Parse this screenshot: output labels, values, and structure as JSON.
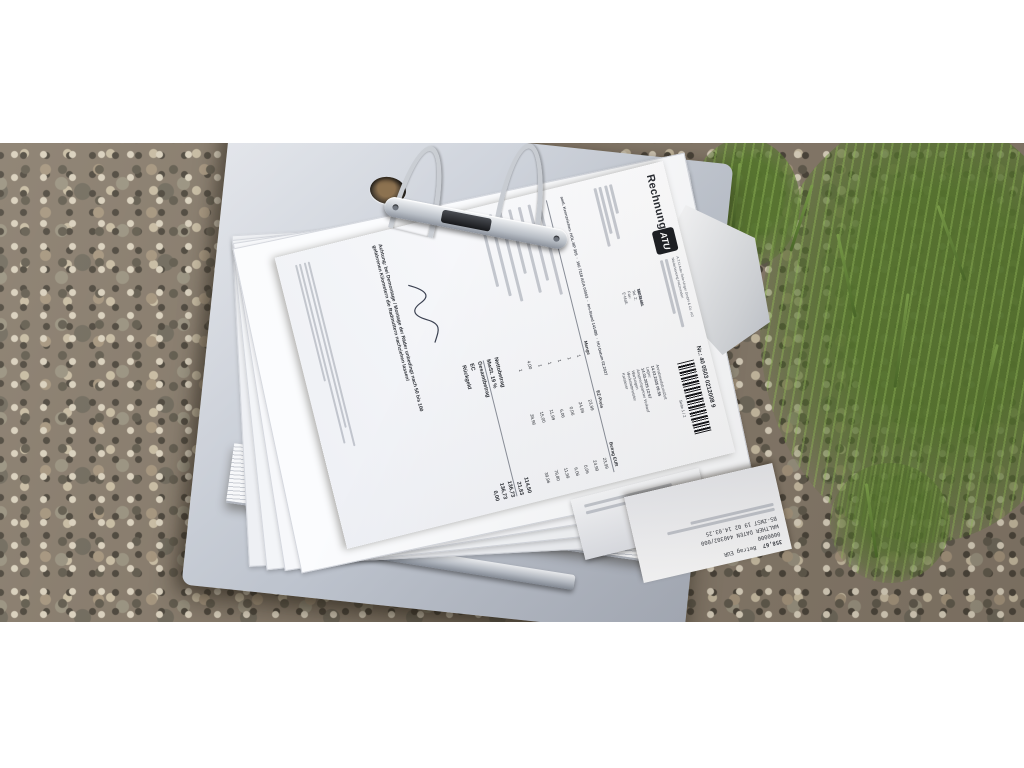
{
  "colors": {
    "gravel_base": "#85796a",
    "stone_light": "#d8cfbc",
    "stone_dark": "#4a443a",
    "grass_green": "#587830",
    "binder_gray": "#c3c8d2",
    "paper_white": "#fafbfd",
    "ink": "#2a2d33"
  },
  "invoice": {
    "title": "Rechnung",
    "brand": "ATU",
    "sender_line1": "A.T.U Auto-Teile-Unger GmbH & Co. KG",
    "sender_line2": "Niederlassung Holzminden",
    "doc_no": "Nr.: 40 0503 0212008 9",
    "page_label": "Seite 1 / 2",
    "customer_no_label": "Kundennr.",
    "customer_no": "10771481",
    "contact_labels": {
      "tel1": "Tel. 1:",
      "tel2": "Tel. 2:",
      "fax": "Fax:",
      "email": "E-Mail:"
    },
    "meta": {
      "l1": "Annahmedatum/Zeit",
      "v1": "14.03.2025 09:55",
      "l2": "Lager:",
      "v2": "14.03.2025 12:57",
      "l3": "Ansprechpartner Verkauf",
      "l4": "Wartungen",
      "l5": "Werkstattmeister",
      "l6": "Kassierer"
    },
    "vehicle": {
      "plate_label": "amtl. Kennzeichen:",
      "plate": "HOL-NP 305",
      "part_no": "160 7118 AGA 00003",
      "km_label": "km-Stand",
      "km": "141489",
      "hu_label": "HU-Datum",
      "hu": "02.2027"
    },
    "table": {
      "headers": {
        "qty": "Menge",
        "unit": "EZ-Preis",
        "amount": "Betrag EUR"
      },
      "rows": [
        {
          "qty": "1",
          "unit": "23,99",
          "amount": "23,99"
        },
        {
          "qty": "1",
          "unit": "24,99",
          "amount": "24,99"
        },
        {
          "qty": "1",
          "unit": "0,06",
          "amount": "0,06"
        },
        {
          "qty": "1",
          "unit": "6,06",
          "amount": "6,06"
        },
        {
          "qty": "1",
          "unit": "11,99",
          "amount": "11,99"
        },
        {
          "qty": "4,00",
          "unit": "15,00",
          "amount": "79,80"
        },
        {
          "qty": "1",
          "unit": "39,96",
          "amount": "39,96"
        }
      ]
    },
    "totals": [
      {
        "label": "Nettobetrag",
        "value": "114,50"
      },
      {
        "label": "MwSt. 19 %",
        "value": "21,83"
      },
      {
        "label": "Gesamtbetrag",
        "value": "136,73"
      },
      {
        "label": "EC",
        "value": "136,73"
      },
      {
        "label": "Rückgeld",
        "value": "0,00"
      }
    ],
    "warning": "Achtung: bei Demontage / Montage der Räder unbedingt nach 50 bis 100 gefahrenen Kilometern die Radmuttern nachziehen lassen!"
  },
  "receipt": {
    "lines": {
      "l1": "358,67",
      "l2": "Betrag EUR",
      "l3": "0000000",
      "l4": "WALTHER DATEN 440302/000",
      "l5": "BS-ZWST 19 02  14.03.25"
    }
  }
}
